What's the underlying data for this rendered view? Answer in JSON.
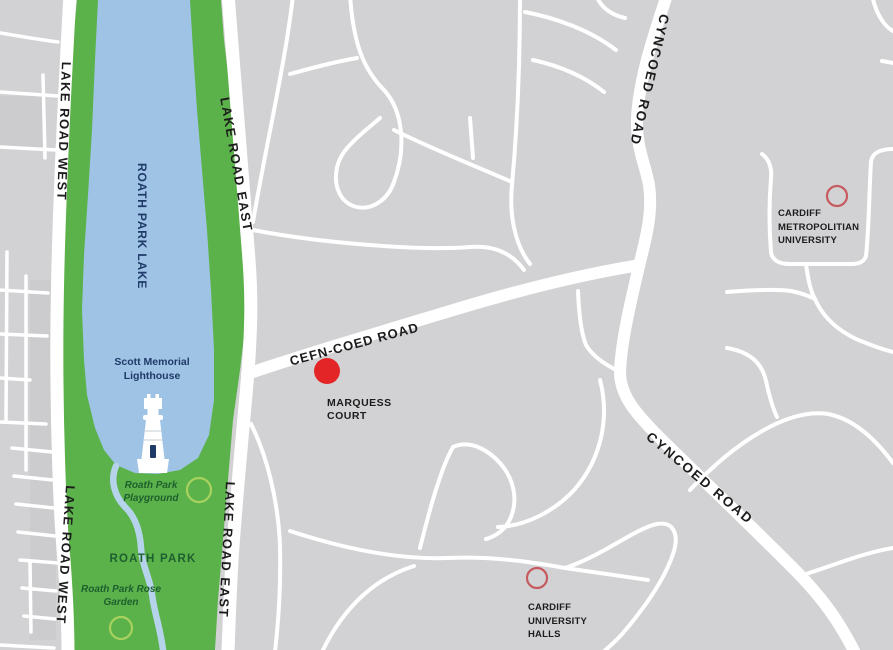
{
  "map": {
    "colors": {
      "bg": "#d2d2d4",
      "road": "#ffffff",
      "park_green": "#5cb24a",
      "lake_blue": "#9fc3e5",
      "stream_blue": "#b5d3ea",
      "navy_text": "#1f3a68",
      "green_text": "#1d5f2e",
      "black_text": "#1c1c1c",
      "marker_red": "#e42527",
      "ring_red": "#c65a5e",
      "ring_green": "#a8d25f"
    },
    "labels": {
      "lake_road_west_top": "LAKE ROAD WEST",
      "lake_road_west_bottom": "LAKE ROAD WEST",
      "lake_road_east_top": "LAKE ROAD EAST",
      "lake_road_east_bottom": "LAKE ROAD EAST",
      "roath_park_lake": "ROATH PARK LAKE",
      "scott_memorial_lighthouse": "Scott Memorial Lighthouse",
      "roath_park_playground": "Roath Park Playground",
      "roath_park": "ROATH PARK",
      "roath_park_rose_garden": "Roath Park Rose Garden",
      "cefn_coed_road": "CEFN-COED ROAD",
      "cyncoed_road_top": "CYNCOED ROAD",
      "cyncoed_road_bottom": "CYNCOED ROAD",
      "marquess_court": "MARQUESS COURT",
      "cardiff_metropolitan_university": "CARDIFF METROPOLITIAN UNIVERSITY",
      "cardiff_university_halls": "CARDIFF UNIVERSITY HALLS"
    },
    "markers": [
      {
        "label": "MARQUESS COURT",
        "type": "filled-circle",
        "color": "#e42527"
      },
      {
        "label": "CARDIFF METROPOLITIAN UNIVERSITY",
        "type": "outline-circle",
        "color": "#c65a5e"
      },
      {
        "label": "CARDIFF UNIVERSITY HALLS",
        "type": "outline-circle",
        "color": "#c65a5e"
      },
      {
        "label": "Roath Park Playground",
        "type": "outline-circle",
        "color": "#a8d25f"
      },
      {
        "label": "Roath Park Rose Garden",
        "type": "outline-circle",
        "color": "#a8d25f"
      }
    ]
  }
}
